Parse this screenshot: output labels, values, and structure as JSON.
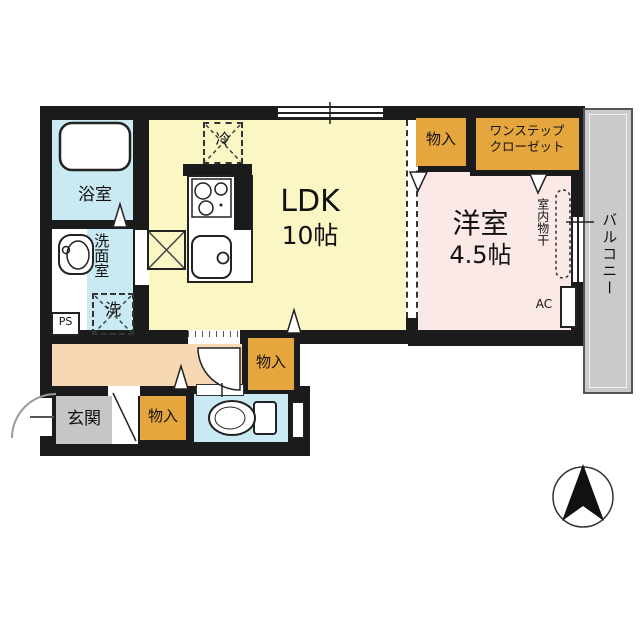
{
  "plan": {
    "bathroom": "浴室",
    "washroom": "洗面室",
    "washer": "洗",
    "ps": "PS",
    "fridge": "冷",
    "ldk_name": "LDK",
    "ldk_size": "10帖",
    "storage_top": "物入",
    "closet_line1": "ワンステップ",
    "closet_line2": "クローゼット",
    "western_name": "洋室",
    "western_size": "4.5帖",
    "indoor_drying": "室内物干",
    "ac": "AC",
    "balcony": "バルコニー",
    "storage_hall": "物入",
    "entrance": "玄関",
    "storage_entry": "物入"
  },
  "colors": {
    "wall": "#1b1b1b",
    "ldk_yellow": "#faf7c5",
    "western_pink": "#fbe9e7",
    "wet_cyan": "#c9eaf2",
    "closet_orange": "#e6a63e",
    "hall_peach": "#f6d9b4",
    "entrance_gray": "#c6c6c6",
    "balcony_gray": "#cacaca"
  }
}
